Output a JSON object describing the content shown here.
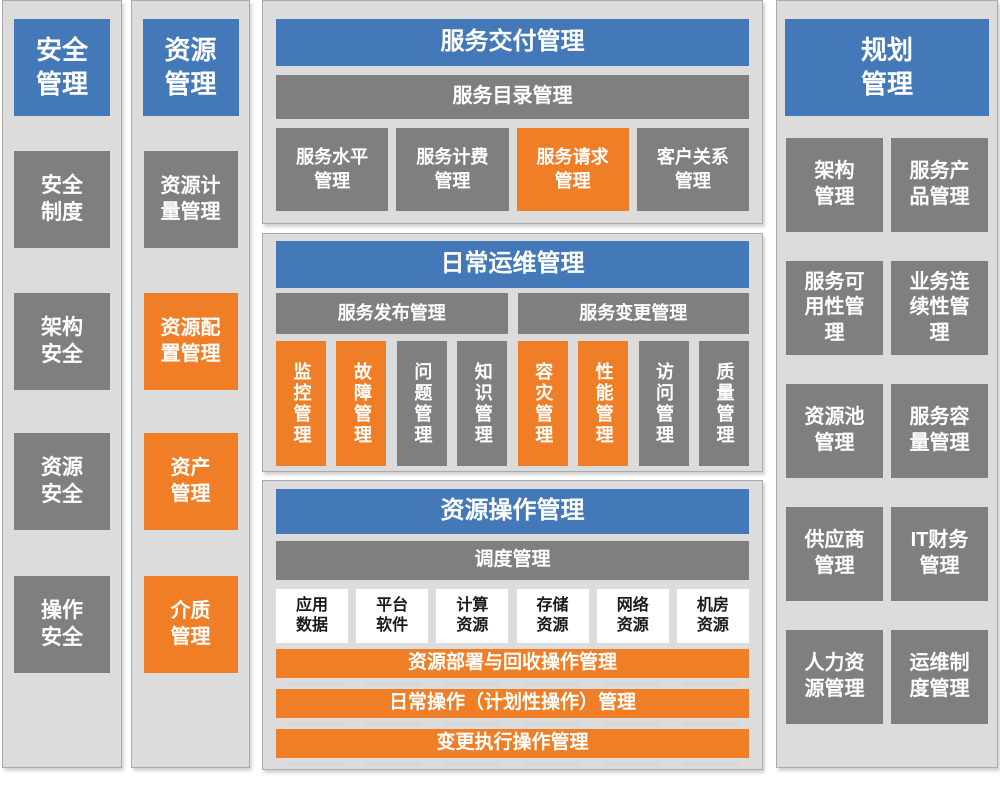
{
  "palette": {
    "blue": "#4379B9",
    "orange": "#F07E26",
    "gray": "#7F7F7F",
    "panel_bg": "#DCDCDC"
  },
  "security": {
    "title": "安全\n管理",
    "items": [
      {
        "label": "安全\n制度"
      },
      {
        "label": "架构\n安全"
      },
      {
        "label": "资源\n安全"
      },
      {
        "label": "操作\n安全"
      }
    ]
  },
  "resource": {
    "title": "资源\n管理",
    "items": [
      {
        "label": "资源计\n量管理"
      },
      {
        "label": "资源配\n置管理"
      },
      {
        "label": "资产\n管理"
      },
      {
        "label": "介质\n管理"
      }
    ]
  },
  "service_delivery": {
    "title": "服务交付管理",
    "catalog": "服务目录管理",
    "boxes": [
      {
        "label": "服务水平\n管理"
      },
      {
        "label": "服务计费\n管理"
      },
      {
        "label": "服务请求\n管理"
      },
      {
        "label": "客户关系\n管理"
      }
    ]
  },
  "daily_ops": {
    "title": "日常运维管理",
    "release_bar": "服务发布管理",
    "change_bar": "服务变更管理",
    "boxes": [
      {
        "label": "监控管理"
      },
      {
        "label": "故障管理"
      },
      {
        "label": "问题管理"
      },
      {
        "label": "知识管理"
      },
      {
        "label": "容灾管理"
      },
      {
        "label": "性能管理"
      },
      {
        "label": "访问管理"
      },
      {
        "label": "质量管理"
      }
    ]
  },
  "resource_ops": {
    "title": "资源操作管理",
    "dispatch": "调度管理",
    "resources": [
      {
        "label": "应用\n数据"
      },
      {
        "label": "平台\n软件"
      },
      {
        "label": "计算\n资源"
      },
      {
        "label": "存储\n资源"
      },
      {
        "label": "网络\n资源"
      },
      {
        "label": "机房\n资源"
      }
    ],
    "bars": [
      {
        "label": "资源部署与回收操作管理"
      },
      {
        "label": "日常操作（计划性操作）管理"
      },
      {
        "label": "变更执行操作管理"
      }
    ]
  },
  "planning": {
    "title": "规划\n管理",
    "boxes": [
      {
        "label": "架构\n管理"
      },
      {
        "label": "服务产\n品管理"
      },
      {
        "label": "服务可\n用性管\n理"
      },
      {
        "label": "业务连\n续性管\n理"
      },
      {
        "label": "资源池\n管理"
      },
      {
        "label": "服务容\n量管理"
      },
      {
        "label": "供应商\n管理"
      },
      {
        "label": "IT财务\n管理"
      },
      {
        "label": "人力资\n源管理"
      },
      {
        "label": "运维制\n度管理"
      }
    ]
  }
}
